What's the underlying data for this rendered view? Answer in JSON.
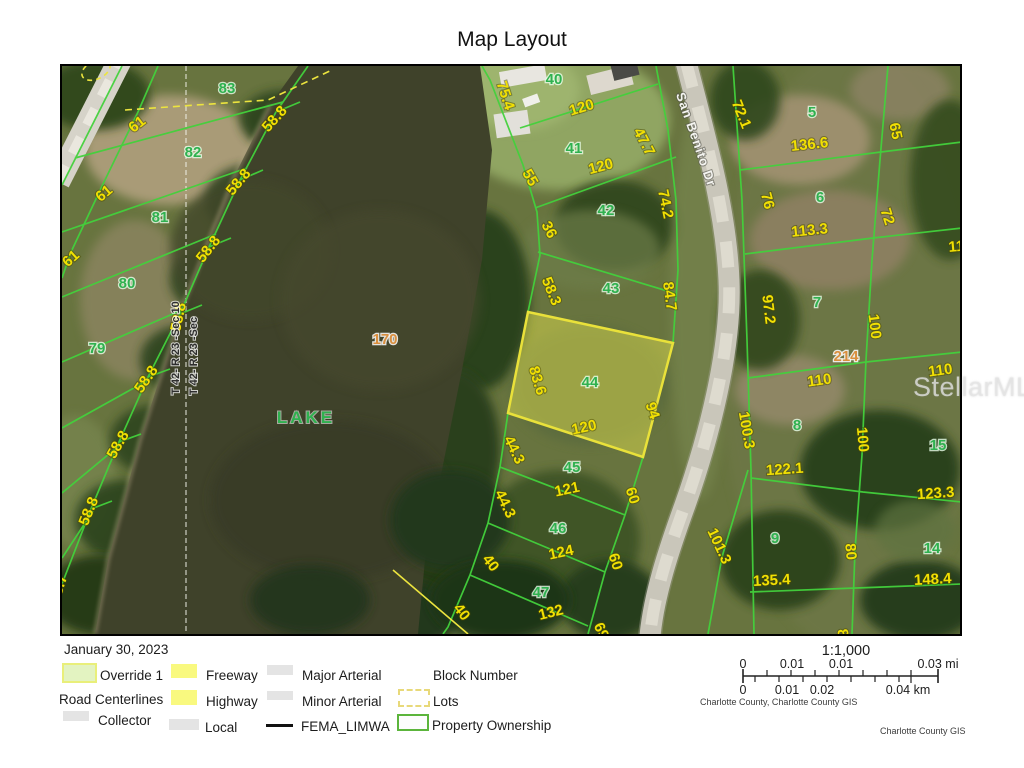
{
  "header": {
    "title": "Map Layout"
  },
  "watermark": "StellarMLS",
  "colors": {
    "parcel_line_green": "#43d13c",
    "dimension_yellow": "#f2e003",
    "lot_number_green": "#2fb14f",
    "block_number_tan": "#d98f3e",
    "highlight_parcel_yellow": "#e9e13a",
    "water": "#3f422a",
    "road_gray": "#c9c6ba"
  },
  "legend": {
    "date": "January 30, 2023",
    "override": {
      "label": "Override 1"
    },
    "road_centerlines": {
      "label": "Road Centerlines"
    },
    "freeway": {
      "label": "Freeway"
    },
    "highway": {
      "label": "Highway"
    },
    "collector": {
      "label": "Collector"
    },
    "local": {
      "label": "Local"
    },
    "major_arterial": {
      "label": "Major Arterial"
    },
    "minor_arterial": {
      "label": "Minor Arterial"
    },
    "fema": {
      "label": "FEMA_LIMWA"
    },
    "block_number": {
      "label": "Block Number"
    },
    "lots": {
      "label": "Lots"
    },
    "property_ownership": {
      "label": "Property Ownership"
    }
  },
  "scalebar": {
    "ratio": "1:1,000",
    "mi": [
      "0",
      "0.01",
      "0.01",
      "0.03 mi"
    ],
    "km": [
      "0",
      "0.01",
      "0.02",
      "0.04 km"
    ],
    "source": "Charlotte County, Charlotte County GIS",
    "credit": "Charlotte County GIS"
  },
  "map": {
    "labels": [
      {
        "text": "61",
        "x": 140,
        "y": 128,
        "rot": -38,
        "type": "dim"
      },
      {
        "text": "61",
        "x": 107,
        "y": 197,
        "rot": -40,
        "type": "dim"
      },
      {
        "text": "61",
        "x": 74,
        "y": 262,
        "rot": -42,
        "type": "dim"
      },
      {
        "text": "58.8",
        "x": 278,
        "y": 122,
        "rot": -48,
        "type": "dim"
      },
      {
        "text": "58.8",
        "x": 242,
        "y": 185,
        "rot": -50,
        "type": "dim"
      },
      {
        "text": "58.8",
        "x": 212,
        "y": 252,
        "rot": -52,
        "type": "dim"
      },
      {
        "text": "58.8",
        "x": 183,
        "y": 318,
        "rot": -78,
        "type": "dim"
      },
      {
        "text": "58.8",
        "x": 150,
        "y": 382,
        "rot": -55,
        "type": "dim"
      },
      {
        "text": "58.8",
        "x": 122,
        "y": 447,
        "rot": -60,
        "type": "dim"
      },
      {
        "text": "58.8",
        "x": 93,
        "y": 513,
        "rot": -68,
        "type": "dim"
      },
      {
        "text": "58.7",
        "x": 63,
        "y": 590,
        "rot": -72,
        "type": "dim"
      },
      {
        "text": "75.4",
        "x": 501,
        "y": 97,
        "rot": 72,
        "type": "dim"
      },
      {
        "text": "120",
        "x": 583,
        "y": 112,
        "rot": -17,
        "type": "dim"
      },
      {
        "text": "55",
        "x": 526,
        "y": 180,
        "rot": 60,
        "type": "dim"
      },
      {
        "text": "120",
        "x": 602,
        "y": 171,
        "rot": -15,
        "type": "dim"
      },
      {
        "text": "47.7",
        "x": 640,
        "y": 144,
        "rot": 62,
        "type": "dim"
      },
      {
        "text": "74.2",
        "x": 661,
        "y": 205,
        "rot": 78,
        "type": "dim"
      },
      {
        "text": "36",
        "x": 545,
        "y": 232,
        "rot": 62,
        "type": "dim"
      },
      {
        "text": "58.3",
        "x": 547,
        "y": 293,
        "rot": 68,
        "type": "dim"
      },
      {
        "text": "84.7",
        "x": 665,
        "y": 297,
        "rot": 82,
        "type": "dim"
      },
      {
        "text": "83.6",
        "x": 533,
        "y": 382,
        "rot": 73,
        "type": "dim"
      },
      {
        "text": "120",
        "x": 585,
        "y": 432,
        "rot": -12,
        "type": "dim"
      },
      {
        "text": "94",
        "x": 648,
        "y": 412,
        "rot": 72,
        "type": "dim"
      },
      {
        "text": "44.3",
        "x": 510,
        "y": 452,
        "rot": 64,
        "type": "dim"
      },
      {
        "text": "121",
        "x": 568,
        "y": 494,
        "rot": -12,
        "type": "dim"
      },
      {
        "text": "60",
        "x": 628,
        "y": 497,
        "rot": 72,
        "type": "dim"
      },
      {
        "text": "44.3",
        "x": 501,
        "y": 506,
        "rot": 64,
        "type": "dim"
      },
      {
        "text": "124",
        "x": 562,
        "y": 557,
        "rot": -12,
        "type": "dim"
      },
      {
        "text": "60",
        "x": 611,
        "y": 563,
        "rot": 72,
        "type": "dim"
      },
      {
        "text": "40",
        "x": 487,
        "y": 566,
        "rot": 52,
        "type": "dim"
      },
      {
        "text": "132",
        "x": 552,
        "y": 617,
        "rot": -14,
        "type": "dim"
      },
      {
        "text": "40",
        "x": 458,
        "y": 615,
        "rot": 52,
        "type": "dim"
      },
      {
        "text": "69",
        "x": 597,
        "y": 633,
        "rot": 65,
        "type": "dim"
      },
      {
        "text": "72.1",
        "x": 737,
        "y": 116,
        "rot": 68,
        "type": "dim"
      },
      {
        "text": "136.6",
        "x": 810,
        "y": 149,
        "rot": -6,
        "type": "dim"
      },
      {
        "text": "65",
        "x": 891,
        "y": 132,
        "rot": 78,
        "type": "dim"
      },
      {
        "text": "76",
        "x": 763,
        "y": 202,
        "rot": 75,
        "type": "dim"
      },
      {
        "text": "113.3",
        "x": 810,
        "y": 235,
        "rot": -6,
        "type": "dim"
      },
      {
        "text": "72",
        "x": 883,
        "y": 218,
        "rot": 72,
        "type": "dim"
      },
      {
        "text": "97.2",
        "x": 764,
        "y": 310,
        "rot": 83,
        "type": "dim"
      },
      {
        "text": "100",
        "x": 870,
        "y": 327,
        "rot": 83,
        "type": "dim"
      },
      {
        "text": "110",
        "x": 961,
        "y": 251,
        "rot": -5,
        "type": "dim"
      },
      {
        "text": "110",
        "x": 820,
        "y": 385,
        "rot": -8,
        "type": "dim"
      },
      {
        "text": "110",
        "x": 941,
        "y": 375,
        "rot": -8,
        "type": "dim"
      },
      {
        "text": "100.3",
        "x": 742,
        "y": 431,
        "rot": 80,
        "type": "dim"
      },
      {
        "text": "100",
        "x": 858,
        "y": 440,
        "rot": 85,
        "type": "dim"
      },
      {
        "text": "122.1",
        "x": 785,
        "y": 474,
        "rot": -4,
        "type": "dim"
      },
      {
        "text": "123.3",
        "x": 936,
        "y": 498,
        "rot": -4,
        "type": "dim"
      },
      {
        "text": "101.3",
        "x": 715,
        "y": 548,
        "rot": 65,
        "type": "dim"
      },
      {
        "text": "80",
        "x": 846,
        "y": 552,
        "rot": 85,
        "type": "dim"
      },
      {
        "text": "135.4",
        "x": 772,
        "y": 585,
        "rot": -3,
        "type": "dim"
      },
      {
        "text": "148.4",
        "x": 933,
        "y": 584,
        "rot": -3,
        "type": "dim"
      },
      {
        "text": "8",
        "x": 838,
        "y": 634,
        "rot": 80,
        "type": "dim"
      },
      {
        "text": "83",
        "x": 227,
        "y": 93,
        "rot": 0,
        "type": "lot"
      },
      {
        "text": "82",
        "x": 193,
        "y": 157,
        "rot": 0,
        "type": "lot"
      },
      {
        "text": "81",
        "x": 160,
        "y": 222,
        "rot": 0,
        "type": "lot"
      },
      {
        "text": "80",
        "x": 127,
        "y": 288,
        "rot": 0,
        "type": "lot"
      },
      {
        "text": "79",
        "x": 97,
        "y": 353,
        "rot": 0,
        "type": "lot"
      },
      {
        "text": "40",
        "x": 554,
        "y": 84,
        "rot": 0,
        "type": "lot"
      },
      {
        "text": "41",
        "x": 574,
        "y": 153,
        "rot": 0,
        "type": "lot"
      },
      {
        "text": "42",
        "x": 606,
        "y": 215,
        "rot": 0,
        "type": "lot"
      },
      {
        "text": "43",
        "x": 611,
        "y": 293,
        "rot": 0,
        "type": "lot"
      },
      {
        "text": "44",
        "x": 590,
        "y": 387,
        "rot": 0,
        "type": "lot"
      },
      {
        "text": "45",
        "x": 572,
        "y": 472,
        "rot": 0,
        "type": "lot"
      },
      {
        "text": "46",
        "x": 558,
        "y": 533,
        "rot": 0,
        "type": "lot"
      },
      {
        "text": "47",
        "x": 541,
        "y": 597,
        "rot": 0,
        "type": "lot"
      },
      {
        "text": "5",
        "x": 812,
        "y": 117,
        "rot": 0,
        "type": "lot"
      },
      {
        "text": "6",
        "x": 820,
        "y": 202,
        "rot": 0,
        "type": "lot"
      },
      {
        "text": "7",
        "x": 817,
        "y": 307,
        "rot": 0,
        "type": "lot"
      },
      {
        "text": "8",
        "x": 797,
        "y": 430,
        "rot": 0,
        "type": "lot"
      },
      {
        "text": "15",
        "x": 938,
        "y": 450,
        "rot": 0,
        "type": "lot"
      },
      {
        "text": "9",
        "x": 775,
        "y": 543,
        "rot": 0,
        "type": "lot"
      },
      {
        "text": "14",
        "x": 932,
        "y": 553,
        "rot": 0,
        "type": "lot"
      },
      {
        "text": "170",
        "x": 385,
        "y": 344,
        "rot": 0,
        "type": "block"
      },
      {
        "text": "214",
        "x": 846,
        "y": 361,
        "rot": 0,
        "type": "block"
      },
      {
        "text": "LAKE",
        "x": 306,
        "y": 423,
        "rot": 0,
        "type": "lake"
      },
      {
        "text": "San Benito Dr",
        "x": 692,
        "y": 141,
        "rot": 71,
        "type": "road"
      },
      {
        "text": "T 42- R 23 -Sec 10",
        "x": 179,
        "y": 348,
        "rot": -90,
        "type": "section"
      },
      {
        "text": "T 42- R 23 -Sec",
        "x": 197,
        "y": 356,
        "rot": -90,
        "type": "section"
      }
    ]
  }
}
